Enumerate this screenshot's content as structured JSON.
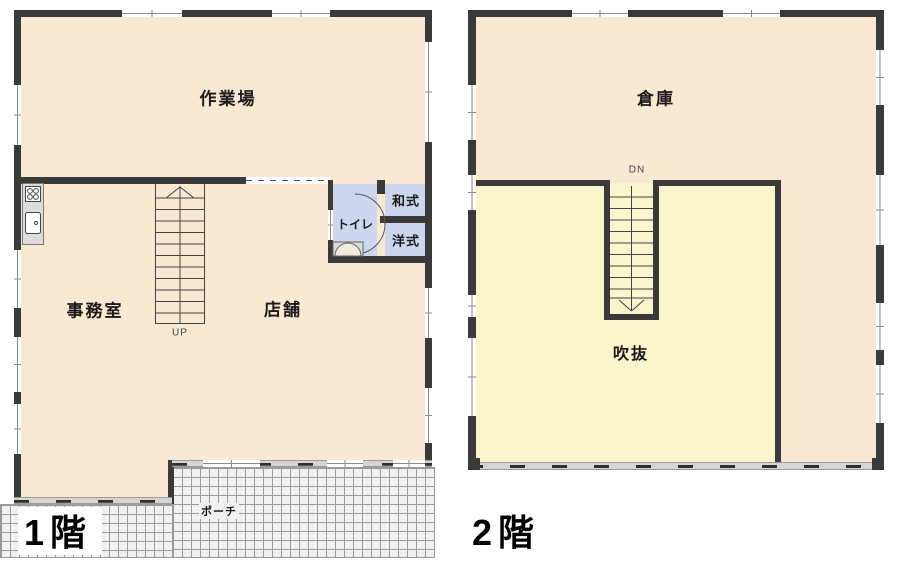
{
  "colors": {
    "wall": "#3a3a3a",
    "room_cream": "#f9e8d2",
    "room_yellow": "#f8f4cc",
    "room_blue": "#ccd7ee",
    "porch_bg": "#f0f0f0",
    "porch_line": "#9a9a9a",
    "band_gray": "#d5d5d5",
    "fixture_gray": "#dcdcdc"
  },
  "floor1": {
    "title": "1階",
    "labels": {
      "workshop": "作業場",
      "office": "事務室",
      "shop": "店舗",
      "toilet": "トイレ",
      "toilet_japanese": "和式",
      "toilet_western": "洋式",
      "porch": "ポーチ",
      "stairs": "UP"
    }
  },
  "floor2": {
    "title": "2階",
    "labels": {
      "warehouse": "倉庫",
      "atrium": "吹抜",
      "stairs": "DN"
    }
  }
}
